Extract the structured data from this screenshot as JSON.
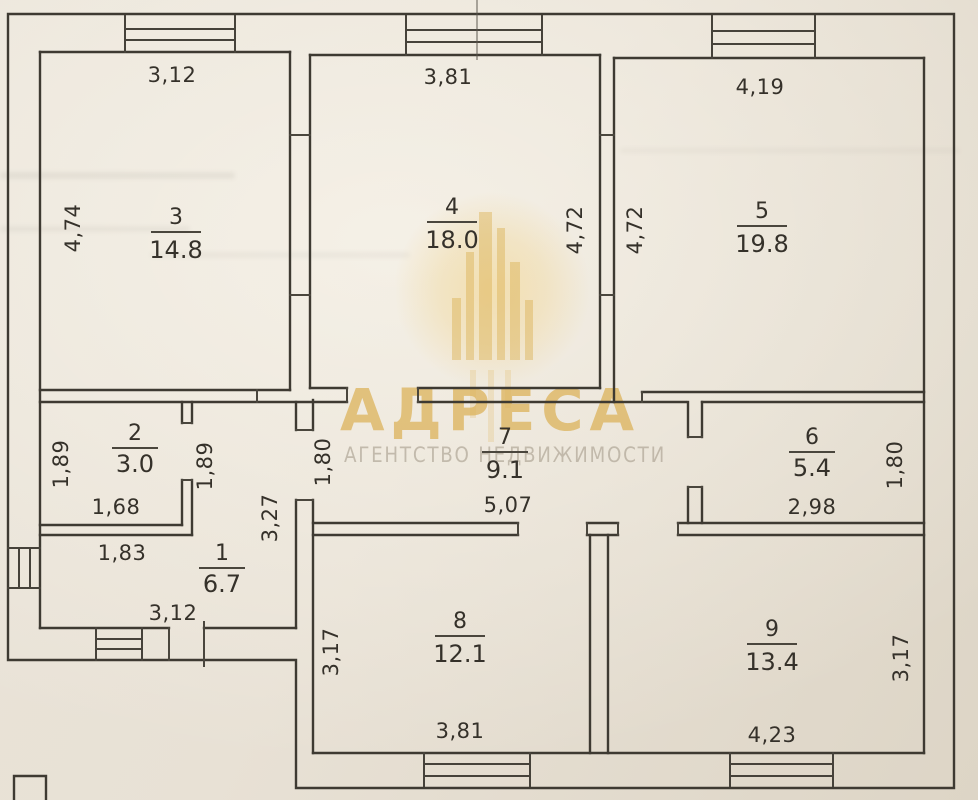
{
  "floorplan": {
    "paper_color": "#e8e1d5",
    "ink_color": "#3e3a32",
    "rooms": [
      {
        "number": "1",
        "area": "6.7",
        "dims": {
          "right": "3,27",
          "bottom": "3,12"
        }
      },
      {
        "number": "2",
        "area": "3.0",
        "dims": {
          "left": "1,89",
          "right": "1,89",
          "bottom_inner": "1,68",
          "bottom_outer": "1,83"
        }
      },
      {
        "number": "3",
        "area": "14.8",
        "dims": {
          "top": "3,12",
          "left": "4,74"
        }
      },
      {
        "number": "4",
        "area": "18.0",
        "dims": {
          "top": "3,81",
          "right": "4,72"
        }
      },
      {
        "number": "5",
        "area": "19.8",
        "dims": {
          "top": "4,19",
          "left": "4,72"
        }
      },
      {
        "number": "6",
        "area": "5.4",
        "dims": {
          "right": "1,80",
          "bottom": "2,98"
        }
      },
      {
        "number": "7",
        "area": "9.1",
        "dims": {
          "left": "1,80",
          "bottom": "5,07"
        }
      },
      {
        "number": "8",
        "area": "12.1",
        "dims": {
          "left": "3,17",
          "bottom": "3,81"
        }
      },
      {
        "number": "9",
        "area": "13.4",
        "dims": {
          "right": "3,17",
          "bottom": "4,23"
        }
      }
    ],
    "watermark": {
      "title": "АДРЕСА",
      "subtitle": "АГЕНТСТВО НЕДВИЖИМОСТИ",
      "accent_color": "#dcb156"
    }
  }
}
